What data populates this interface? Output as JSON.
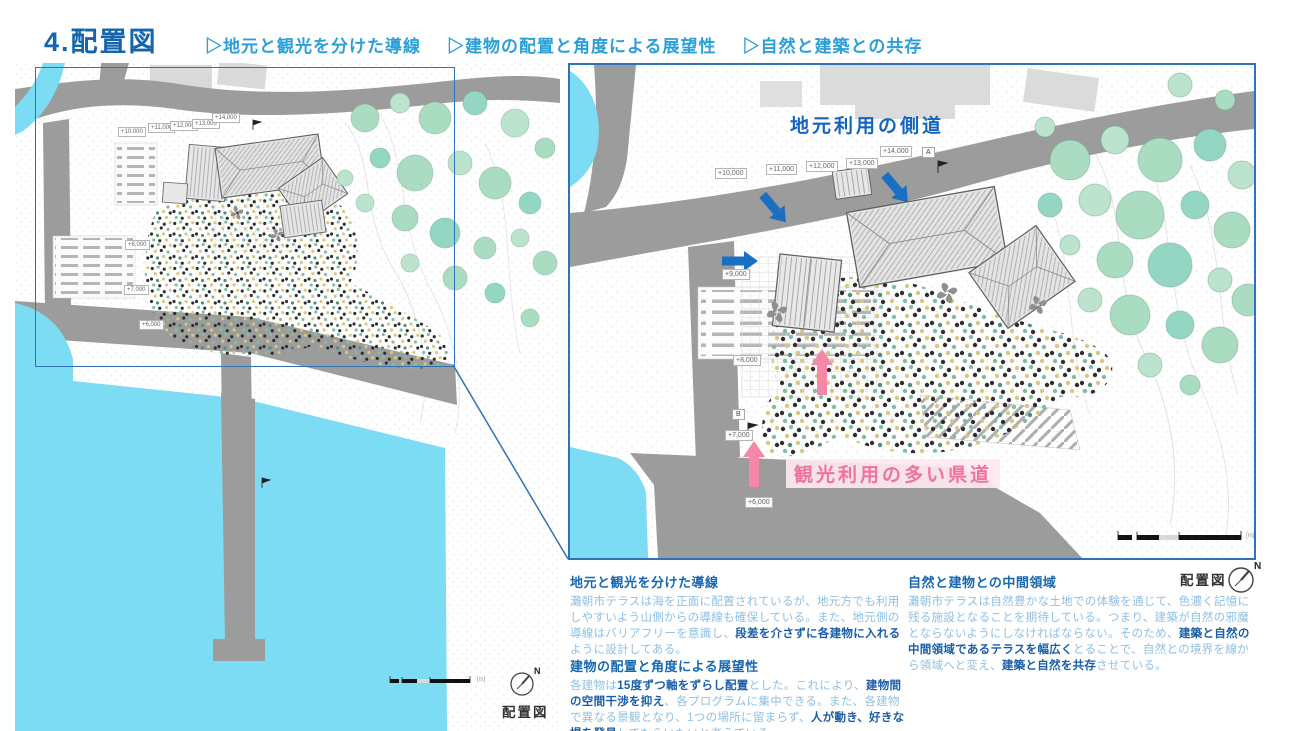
{
  "header": {
    "title": "4.配置図",
    "bullets": [
      "▷地元と観光を分けた導線",
      "▷建物の配置と角度による展望性",
      "▷自然と建築との共存"
    ]
  },
  "maps": {
    "left": {
      "caption": "配置図",
      "compass": "N",
      "scale_unit": "[m]",
      "labels": [
        "+10,000",
        "+11,000",
        "+12,000",
        "+13,000",
        "+14,000",
        "+8,000",
        "+7,000",
        "+6,000"
      ]
    },
    "right": {
      "caption": "配置図",
      "compass": "N",
      "scale_unit": "[m]",
      "local_road_note": "地元利用の側道",
      "tourist_road_note": "観光利用の多い県道",
      "labels": [
        "+10,000",
        "+11,000",
        "+12,000",
        "+13,000",
        "+14,000",
        "+9,000",
        "+8,000",
        "+7,000",
        "+6,000"
      ],
      "markers": [
        "A",
        "B"
      ]
    }
  },
  "sections": [
    {
      "heading": "地元と観光を分けた導線",
      "runs": [
        {
          "t": "灘朝市テラスは海を正面に配置されているが、地元方でも利用しやすいよう山側からの導線も確保している。また、地元側の導線はバリアフリーを意識し、",
          "b": false
        },
        {
          "t": "段差を介さずに各建物に入れる",
          "b": true
        },
        {
          "t": "ように設計してある。",
          "b": false
        }
      ]
    },
    {
      "heading": "建物の配置と角度による展望性",
      "runs": [
        {
          "t": "各建物は",
          "b": false
        },
        {
          "t": "15度ずつ軸をずらし配置",
          "b": true
        },
        {
          "t": "とした。これにより、",
          "b": false
        },
        {
          "t": "建物間の空間干渉を抑え",
          "b": true
        },
        {
          "t": "、各プログラムに集中できる。また、各建物で異なる景観となり、1つの場所に留まらず、",
          "b": false
        },
        {
          "t": "人が動き、好きな場を発見",
          "b": true
        },
        {
          "t": "してもらいたいと考えている。",
          "b": false
        }
      ]
    },
    {
      "heading": "自然と建物との中間領域",
      "runs": [
        {
          "t": "灘朝市テラスは自然豊かな土地での体験を通じて、色濃く記憶に残る施設となることを期待している。つまり、建築が自然の邪魔とならないようにしなければならない。そのため、",
          "b": false
        },
        {
          "t": "建築と自然の中間領域であるテラスを幅広く",
          "b": true
        },
        {
          "t": "とることで、自然との境界を線から領域へと変え、",
          "b": false
        },
        {
          "t": "建築と自然を共存",
          "b": true
        },
        {
          "t": "させている。",
          "b": false
        }
      ]
    }
  ],
  "colors": {
    "water": "#7cdcf4",
    "road": "#9c9c9c",
    "frame_blue": "#2e74b5",
    "title_blue": "#1565ae",
    "subtitle_blue": "#2b9fd8",
    "heading_blue": "#1668b0",
    "body_light": "#8fc0e2",
    "body_bold": "#1a5ea8",
    "note_local": "#1565c0",
    "note_tourist": "#f0739e",
    "arrow_blue": "#1b6fc2",
    "arrow_pink": "#f587a8",
    "tree_green": "#a9dcc1"
  }
}
